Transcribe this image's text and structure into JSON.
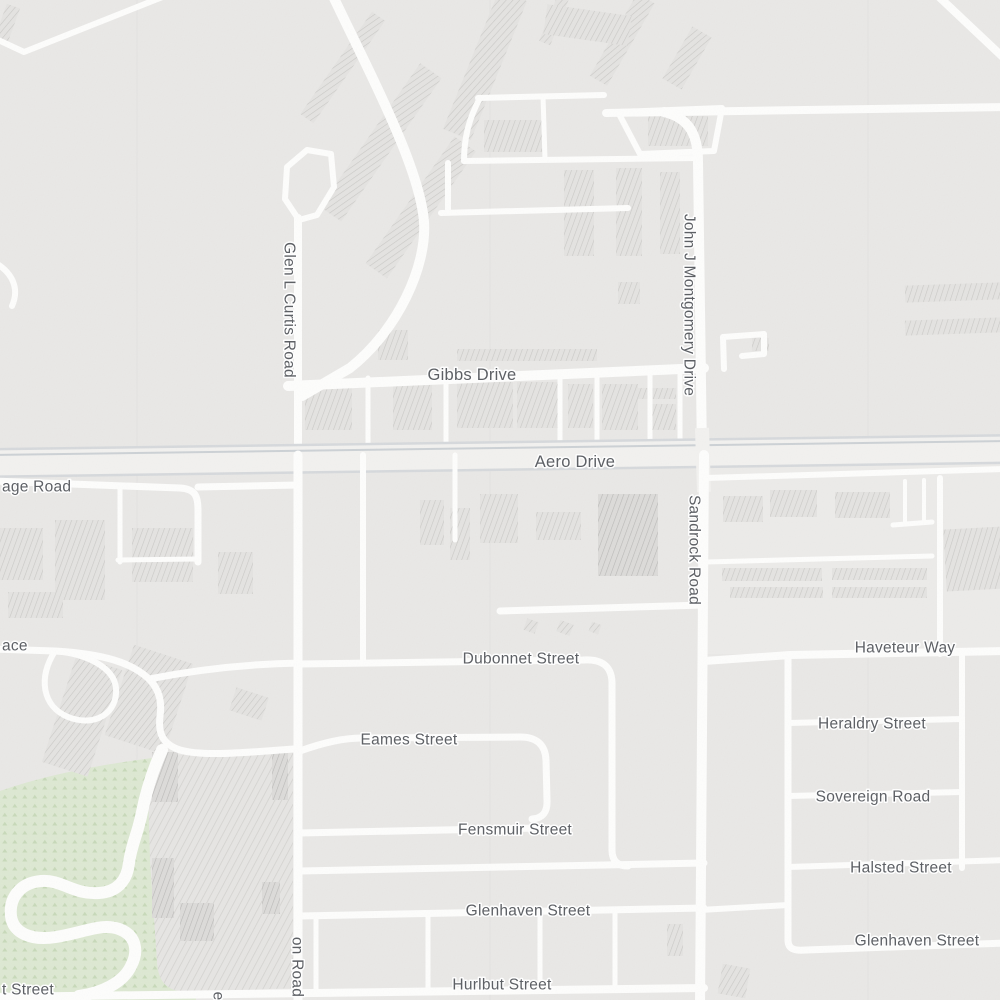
{
  "map": {
    "type": "street-map",
    "colors": {
      "bg": "#e9e8e6",
      "tint": "#ecebe9",
      "road": "#fdfdfc",
      "majorCasing": "#d6d9dc",
      "majorFill": "#f2f1ef",
      "median": "#ccd1d5",
      "hatchBg": "#e4e3e1",
      "hatchLine": "#c9c8c5",
      "hatchDarkBg": "#dcdbd9",
      "hatchDarkLine": "#b9b8b6",
      "stripeBg": "#e6e5e3",
      "stripeLine": "#d2d1ce",
      "parkBg": "#dde8d2",
      "parkTree": "#c0d4b0",
      "label": "#5b5e63",
      "labelHalo": "#ffffff"
    },
    "streets": {
      "glen_curtis": "Glen L Curtis Road",
      "gibbs": "Gibbs Drive",
      "montgomery": "John J Montgomery Drive",
      "aero": "Aero Drive",
      "sandrock": "Sandrock Road",
      "age_road_partial": "age Road",
      "ace_partial": "ace",
      "dubonnet": "Dubonnet Street",
      "eames": "Eames Street",
      "fensmuir": "Fensmuir Street",
      "glenhaven_center": "Glenhaven Street",
      "hurlbut": "Hurlbut Street",
      "haveteur": "Haveteur Way",
      "heraldry": "Heraldry Street",
      "sovereign": "Sovereign Road",
      "halsted": "Halsted Street",
      "glenhaven_right": "Glenhaven Street",
      "t_street_partial": "t Street",
      "on_road_partial": "on Road",
      "e_partial": "e"
    }
  }
}
